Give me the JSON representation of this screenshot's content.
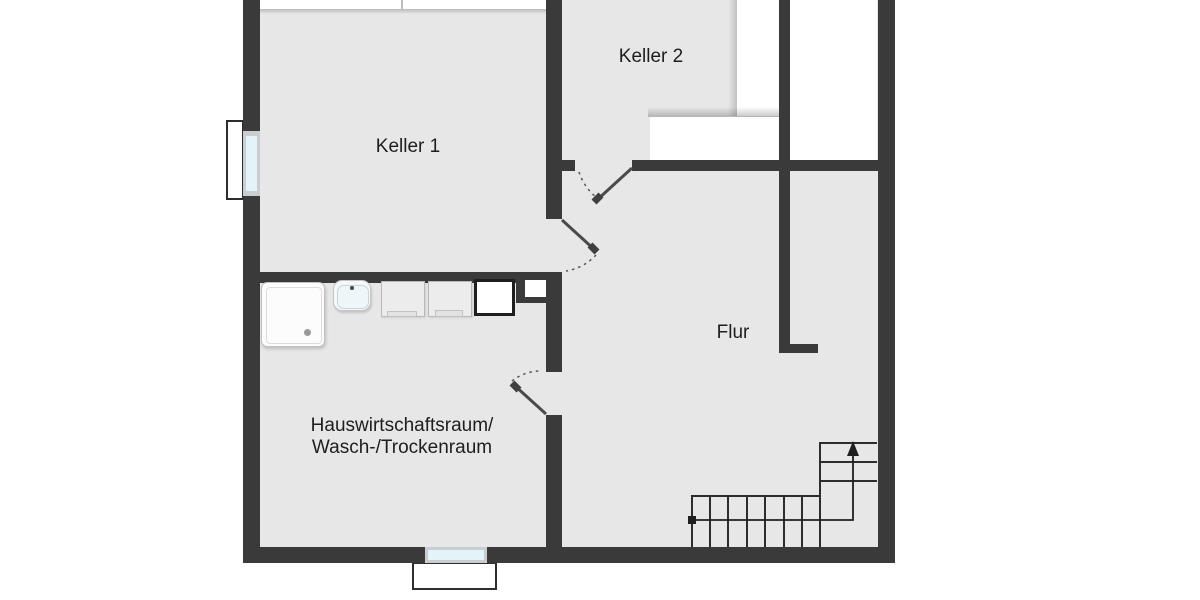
{
  "floorplan": {
    "type": "basement-floor-plan",
    "rooms": {
      "keller1": {
        "label": "Keller 1"
      },
      "keller2": {
        "label": "Keller 2"
      },
      "flur": {
        "label": "Flur"
      },
      "hwr": {
        "label_line1": "Hauswirtschaftsraum/",
        "label_line2": "Wasch-/Trockenraum"
      }
    },
    "icons": {
      "shower": "shower-tray-icon",
      "sink": "sink-icon",
      "washing_machine_1": "washing-machine-icon",
      "washing_machine_2": "washing-machine-icon",
      "shaft": "shaft-box-icon",
      "stairs": "staircase-icon",
      "window_left": "window-icon",
      "window_bottom": "window-icon",
      "doors": [
        "door-swing-icon",
        "door-swing-icon",
        "door-swing-icon"
      ]
    },
    "colors": {
      "wall": "#3a3a3a",
      "floor": "#e7e7e7",
      "background": "#ffffff",
      "window_glass": "#e4f3f8",
      "window_frame": "#c9ced0",
      "line": "#2d2d2d",
      "text": "#1e1e1e"
    }
  }
}
